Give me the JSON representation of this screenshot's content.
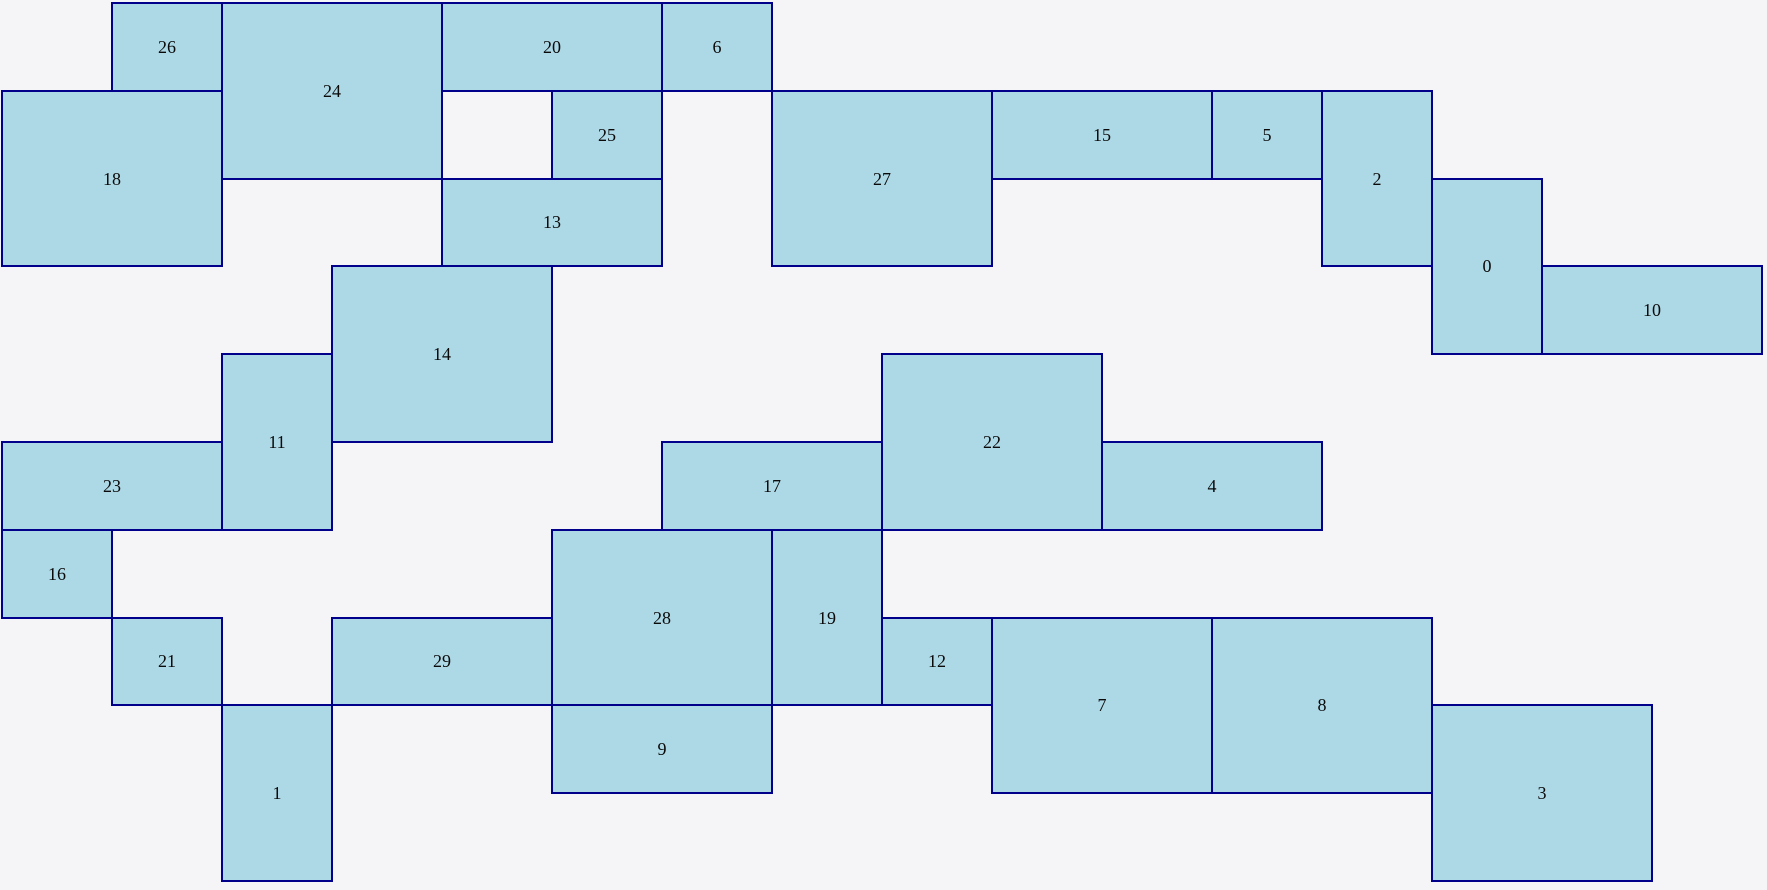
{
  "canvas": {
    "width": 1767,
    "height": 890,
    "background_color": "#f5f5f7"
  },
  "style": {
    "box_fill_color": "#add8e6",
    "box_border_color": "#00008b",
    "box_border_width_px": 2,
    "label_color": "#0a0a0a"
  },
  "grid": {
    "origin_x": 2,
    "origin_y": 3,
    "unit_width": 110,
    "unit_height": 87.8,
    "columns": 16,
    "rows": 10
  },
  "boxes": [
    {
      "label": "0",
      "col": 13,
      "row": 2,
      "w": 1,
      "h": 2
    },
    {
      "label": "1",
      "col": 2,
      "row": 8,
      "w": 1,
      "h": 2
    },
    {
      "label": "2",
      "col": 12,
      "row": 1,
      "w": 1,
      "h": 2
    },
    {
      "label": "3",
      "col": 13,
      "row": 8,
      "w": 2,
      "h": 2
    },
    {
      "label": "4",
      "col": 10,
      "row": 5,
      "w": 2,
      "h": 1
    },
    {
      "label": "5",
      "col": 11,
      "row": 1,
      "w": 1,
      "h": 1
    },
    {
      "label": "6",
      "col": 6,
      "row": 0,
      "w": 1,
      "h": 1
    },
    {
      "label": "7",
      "col": 9,
      "row": 7,
      "w": 2,
      "h": 2
    },
    {
      "label": "8",
      "col": 11,
      "row": 7,
      "w": 2,
      "h": 2
    },
    {
      "label": "9",
      "col": 5,
      "row": 8,
      "w": 2,
      "h": 1
    },
    {
      "label": "10",
      "col": 14,
      "row": 3,
      "w": 2,
      "h": 1
    },
    {
      "label": "11",
      "col": 2,
      "row": 4,
      "w": 1,
      "h": 2
    },
    {
      "label": "12",
      "col": 8,
      "row": 7,
      "w": 1,
      "h": 1
    },
    {
      "label": "13",
      "col": 4,
      "row": 2,
      "w": 2,
      "h": 1
    },
    {
      "label": "14",
      "col": 3,
      "row": 3,
      "w": 2,
      "h": 2
    },
    {
      "label": "15",
      "col": 9,
      "row": 1,
      "w": 2,
      "h": 1
    },
    {
      "label": "16",
      "col": 0,
      "row": 6,
      "w": 1,
      "h": 1
    },
    {
      "label": "17",
      "col": 6,
      "row": 5,
      "w": 2,
      "h": 1
    },
    {
      "label": "18",
      "col": 0,
      "row": 1,
      "w": 2,
      "h": 2
    },
    {
      "label": "19",
      "col": 7,
      "row": 6,
      "w": 1,
      "h": 2
    },
    {
      "label": "20",
      "col": 4,
      "row": 0,
      "w": 2,
      "h": 1
    },
    {
      "label": "21",
      "col": 1,
      "row": 7,
      "w": 1,
      "h": 1
    },
    {
      "label": "22",
      "col": 8,
      "row": 4,
      "w": 2,
      "h": 2
    },
    {
      "label": "23",
      "col": 0,
      "row": 5,
      "w": 2,
      "h": 1
    },
    {
      "label": "24",
      "col": 2,
      "row": 0,
      "w": 2,
      "h": 2
    },
    {
      "label": "25",
      "col": 5,
      "row": 1,
      "w": 1,
      "h": 1
    },
    {
      "label": "26",
      "col": 1,
      "row": 0,
      "w": 1,
      "h": 1
    },
    {
      "label": "27",
      "col": 7,
      "row": 1,
      "w": 2,
      "h": 2
    },
    {
      "label": "28",
      "col": 5,
      "row": 6,
      "w": 2,
      "h": 2
    },
    {
      "label": "29",
      "col": 3,
      "row": 7,
      "w": 2,
      "h": 1
    }
  ]
}
